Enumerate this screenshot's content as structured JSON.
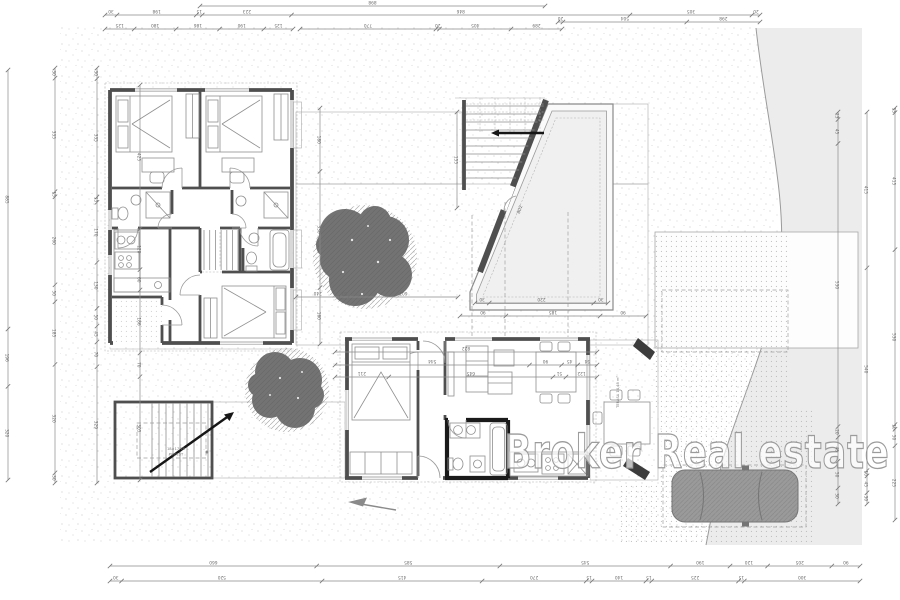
{
  "watermark": {
    "text": "Broker Real estate"
  },
  "plan_labels": {
    "terrace_name": "TERASA",
    "terrace_area": "14,48 m²",
    "stair_note_line1": "18×17/28",
    "stair_note_line2": "PODEST",
    "pool_diagonal_dim": "802"
  },
  "colors": {
    "wall": "#4f4f4f",
    "bath_wall": "#1a1a1a",
    "road": "#ececec",
    "tree": "#737373",
    "car": "#9a9a9a",
    "deck_line": "#c6c6c6",
    "dim_line": "#8a8a8a",
    "dim_text": "#6a6a6a",
    "wm_stroke": "#9b9b9b"
  },
  "dimensions": {
    "chains": [
      {
        "o": "h",
        "x": 200,
        "y": 6,
        "len": 345,
        "labels": [
          "898"
        ]
      },
      {
        "o": "h",
        "x": 105,
        "y": 15,
        "len": 655,
        "labels": [
          "30",
          "198",
          "15",
          "223",
          "846",
          "305",
          "20"
        ]
      },
      {
        "o": "h",
        "x": 105,
        "y": 29,
        "len": 188,
        "labels": [
          "125",
          "180",
          "186",
          "190",
          "125"
        ]
      },
      {
        "o": "h",
        "x": 300,
        "y": 29,
        "len": 262,
        "labels": [
          "770",
          "20",
          "405",
          "289"
        ]
      },
      {
        "o": "h",
        "x": 558,
        "y": 22,
        "len": 202,
        "labels": [
          "20",
          "504",
          "298"
        ]
      },
      {
        "o": "v",
        "x": 8,
        "y": 70,
        "len": 410,
        "labels": [
          "885",
          "196",
          "320"
        ]
      },
      {
        "o": "v",
        "x": 55,
        "y": 68,
        "len": 415,
        "labels": [
          "30",
          "335",
          "15",
          "260",
          "50",
          "185",
          "320",
          "30"
        ]
      },
      {
        "o": "v",
        "x": 97,
        "y": 68,
        "len": 415,
        "labels": [
          "30",
          "335",
          "15",
          "170",
          "130",
          "50",
          "45",
          "70",
          "329"
        ]
      },
      {
        "o": "v",
        "x": 140,
        "y": 85,
        "len": 395,
        "labels": [
          "425",
          "120",
          "60",
          "186",
          "70",
          "305"
        ]
      },
      {
        "o": "v",
        "x": 838,
        "y": 112,
        "len": 392,
        "labels": [
          "13",
          "45",
          "530",
          "20",
          "45",
          "50",
          "30"
        ]
      },
      {
        "o": "v",
        "x": 867,
        "y": 112,
        "len": 392,
        "labels": [
          "415",
          "540",
          "10",
          "45",
          "30"
        ]
      },
      {
        "o": "v",
        "x": 895,
        "y": 108,
        "len": 412,
        "labels": [
          "13",
          "415",
          "530",
          "10",
          "50",
          "225"
        ]
      },
      {
        "o": "h",
        "x": 110,
        "y": 566,
        "len": 750,
        "labels": [
          "660",
          "585",
          "545",
          "190",
          "120",
          "205",
          "90"
        ]
      },
      {
        "o": "h",
        "x": 110,
        "y": 581,
        "len": 750,
        "labels": [
          "30",
          "520",
          "415",
          "270",
          "15",
          "140",
          "15",
          "225",
          "15",
          "300"
        ]
      },
      {
        "o": "h",
        "x": 475,
        "y": 303,
        "len": 133,
        "labels": [
          "30",
          "220",
          "30"
        ]
      },
      {
        "o": "h",
        "x": 460,
        "y": 316,
        "len": 186,
        "labels": [
          "90",
          "185",
          "90"
        ]
      },
      {
        "o": "h",
        "x": 296,
        "y": 297,
        "len": 162,
        "labels": [
          "240",
          "51",
          "602"
        ]
      },
      {
        "o": "h",
        "x": 335,
        "y": 352,
        "len": 262,
        "labels": [
          "822"
        ]
      },
      {
        "o": "h",
        "x": 335,
        "y": 365,
        "len": 262,
        "labels": [
          "544",
          "90",
          "45",
          "54"
        ]
      },
      {
        "o": "h",
        "x": 335,
        "y": 377,
        "len": 262,
        "labels": [
          "211",
          "645",
          "51",
          "122"
        ]
      },
      {
        "o": "v",
        "x": 320,
        "y": 108,
        "len": 236,
        "labels": [
          "180",
          "330",
          "160"
        ]
      },
      {
        "o": "v",
        "x": 457,
        "y": 112,
        "len": 96,
        "labels": [
          "155"
        ]
      }
    ]
  }
}
